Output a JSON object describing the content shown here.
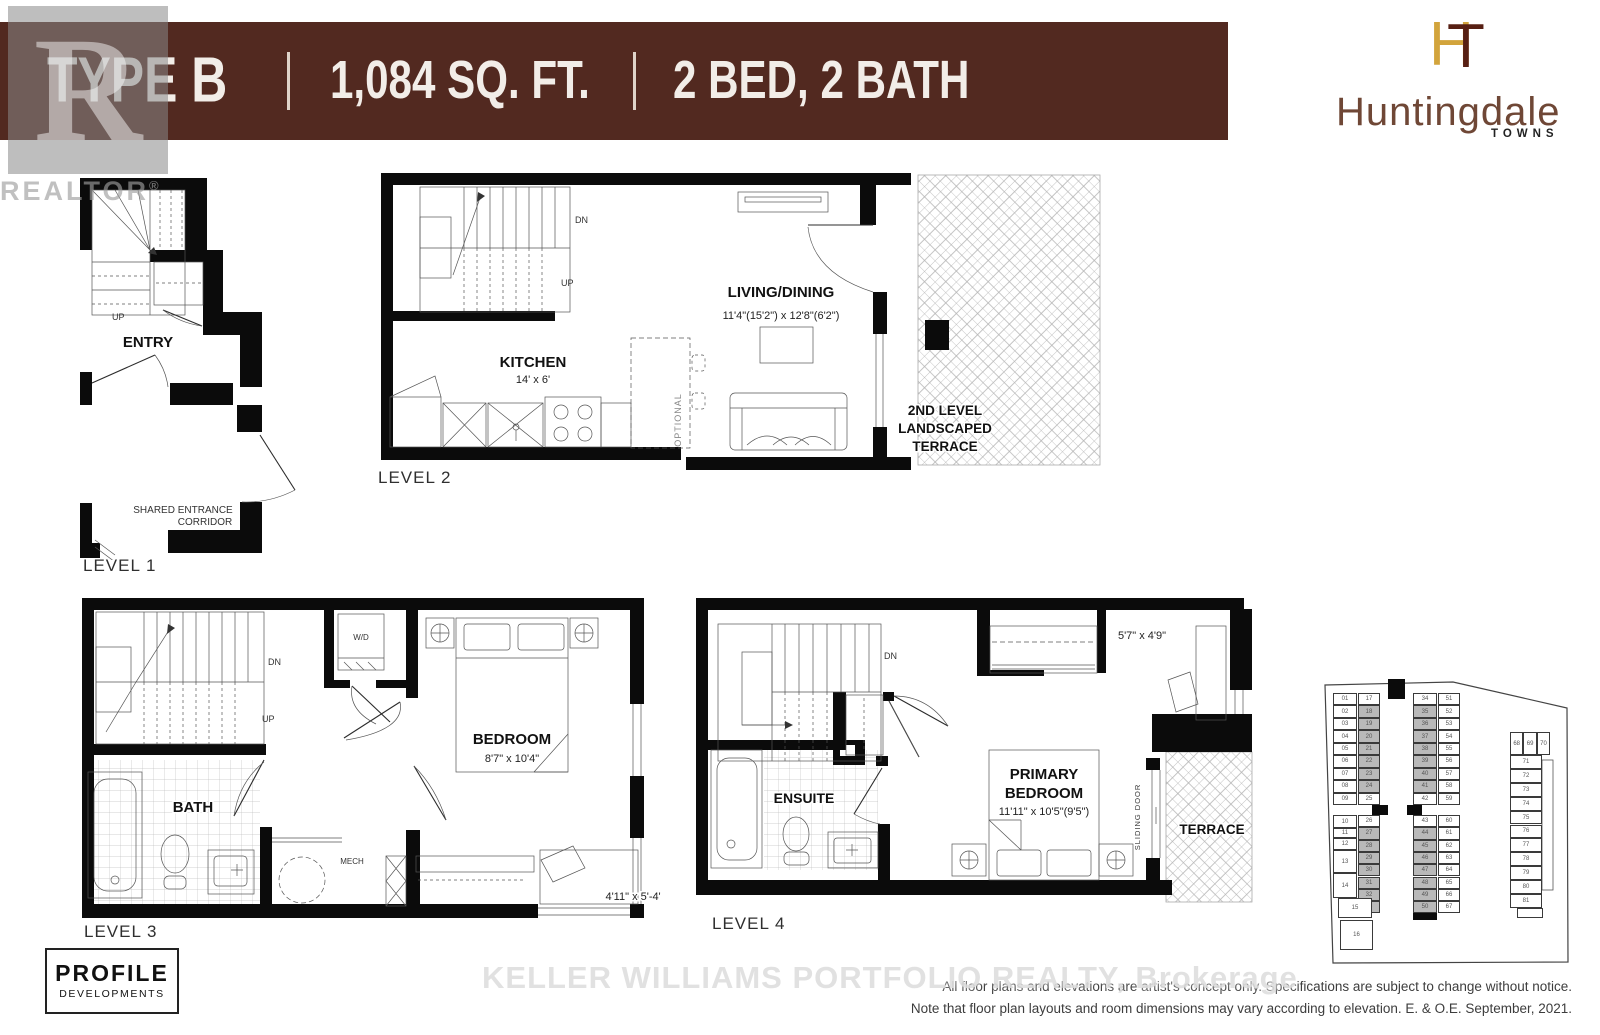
{
  "header": {
    "type_label": "TYPE B",
    "area_label": "1,084 SQ. FT.",
    "bed_bath_label": "2 BED, 2 BATH"
  },
  "brand": {
    "monogram_h": "H",
    "monogram_t": "T",
    "name": "Huntingdale",
    "tagline": "TOWNS"
  },
  "watermarks": {
    "realtor_box_letter": "R",
    "realtor_text": "REALTOR",
    "realtor_reg": "®",
    "brokerage": "KELLER WILLIAMS PORTFOLIO REALTY, Brokerage"
  },
  "levels": {
    "level1": {
      "title": "LEVEL 1",
      "up": "UP",
      "entry": "ENTRY",
      "corridor_line1": "SHARED ENTRANCE",
      "corridor_line2": "CORRIDOR"
    },
    "level2": {
      "title": "LEVEL 2",
      "dn": "DN",
      "up": "UP",
      "kitchen": "KITCHEN",
      "kitchen_dim": "14' x 6'",
      "living": "LIVING/DINING",
      "living_dim": "11'4\"(15'2\") x 12'8\"(6'2\")",
      "optional": "OPTIONAL",
      "terrace_line1": "2ND LEVEL",
      "terrace_line2": "LANDSCAPED",
      "terrace_line3": "TERRACE"
    },
    "level3": {
      "title": "LEVEL 3",
      "dn": "DN",
      "up": "UP",
      "wd": "W/D",
      "bath": "BATH",
      "mech": "MECH",
      "bedroom": "BEDROOM",
      "bedroom_dim": "8'7\" x 10'4\"",
      "desk_dim": "4'11\" x 5'-4\""
    },
    "level4": {
      "title": "LEVEL 4",
      "dn": "DN",
      "closet_dim": "5'7\" x 4'9\"",
      "ensuite": "ENSUITE",
      "primary_line1": "PRIMARY",
      "primary_line2": "BEDROOM",
      "primary_dim": "11'11\" x 10'5\"(9'5\")",
      "sliding_door": "SLIDING DOOR",
      "terrace": "TERRACE"
    }
  },
  "siteplan": {
    "left_top": [
      "01",
      "02",
      "03",
      "04",
      "05",
      "06",
      "07",
      "08",
      "09"
    ],
    "left_bottom": [
      "10",
      "11",
      "12",
      "13",
      "14"
    ],
    "unit15": "15",
    "unit16": "16",
    "inner_left_top": [
      "17",
      "18",
      "19",
      "20",
      "21",
      "22",
      "23",
      "24",
      "25"
    ],
    "inner_left_bottom": [
      "26",
      "27",
      "28",
      "29",
      "30",
      "31",
      "32",
      "33"
    ],
    "inner_right_top": [
      "34",
      "35",
      "36",
      "37",
      "38",
      "39",
      "40",
      "41",
      "42"
    ],
    "inner_right_bottom": [
      "43",
      "44",
      "45",
      "46",
      "47",
      "48",
      "49",
      "50"
    ],
    "outer_right_top": [
      "51",
      "52",
      "53",
      "54",
      "55",
      "56",
      "57",
      "58",
      "59"
    ],
    "outer_right_bottom": [
      "60",
      "61",
      "62",
      "63",
      "64",
      "65",
      "66",
      "67"
    ],
    "right_row": [
      "68",
      "69",
      "70"
    ],
    "right_col": [
      "71",
      "72",
      "73",
      "74",
      "75",
      "76",
      "77",
      "78",
      "79",
      "80",
      "81"
    ],
    "shaded": [
      "18",
      "19",
      "20",
      "21",
      "22",
      "23",
      "24",
      "27",
      "28",
      "29",
      "30",
      "31",
      "32",
      "33",
      "35",
      "36",
      "37",
      "38",
      "39",
      "40",
      "41",
      "44",
      "45",
      "46",
      "47",
      "48",
      "49",
      "50"
    ]
  },
  "footer": {
    "developer_line1": "PROFILE",
    "developer_line2": "DEVELOPMENTS",
    "disclaimer_line1": "All floor plans and elevations are artist's concept only. Specifications are subject to change without notice.",
    "disclaimer_line2": "Note that floor plan layouts and room dimensions may vary according to elevation. E. & O.E. September, 2021."
  },
  "colors": {
    "banner": "#522920",
    "logo_gold": "#d2a43c",
    "logo_brown": "#571f13",
    "shaded_unit": "#b9b9b9"
  }
}
